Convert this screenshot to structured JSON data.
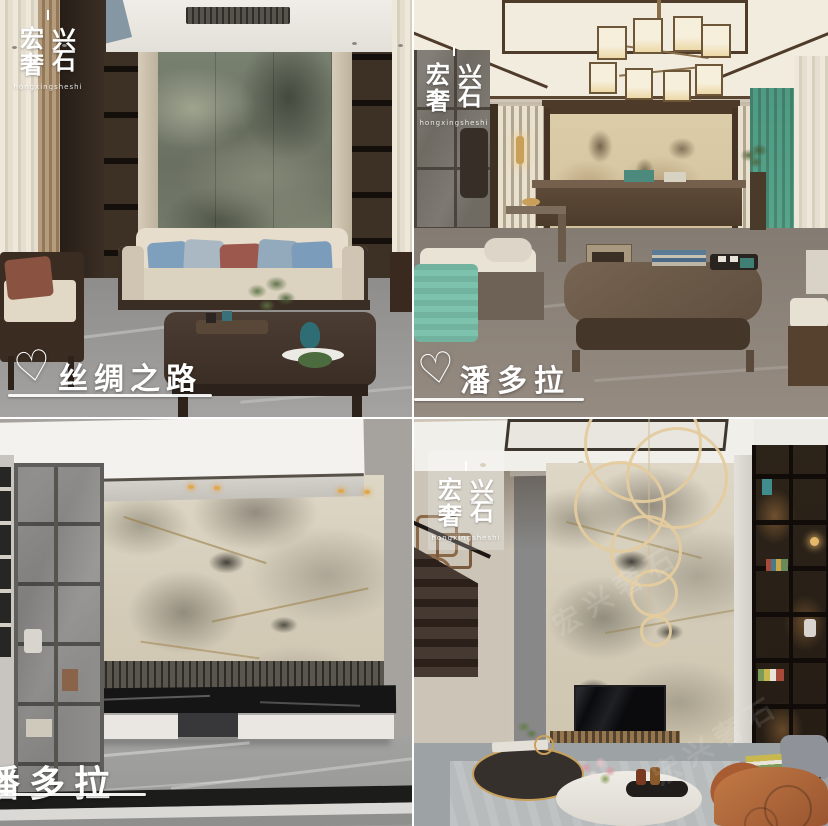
{
  "collage": {
    "brand": {
      "chars": [
        "宏",
        "兴",
        "奢",
        "石"
      ],
      "full": "宏兴奢石",
      "pinyin": "hongxingsheshi"
    },
    "icons": {
      "heart": "♡"
    },
    "quadrants": [
      {
        "name": "silk-road-living-room",
        "caption": "丝绸之路"
      },
      {
        "name": "pandora-living-room",
        "caption": "潘多拉"
      },
      {
        "name": "pandora-tv-wall-room",
        "caption": "潘多拉"
      },
      {
        "name": "pandora-double-height-room",
        "caption": ""
      }
    ],
    "colors": {
      "caption_text": "#ffffff",
      "green_marble": "#6f7366",
      "pandora_marble": "#d8d0bd",
      "beige_marble": "#d8c8a5",
      "teal_accent": "#5aa78e",
      "orange_chair": "#b5693c",
      "gold_accent": "#c9a05a",
      "dark_wood": "#3a2d22",
      "floor_gray": "#9a9a98"
    }
  }
}
